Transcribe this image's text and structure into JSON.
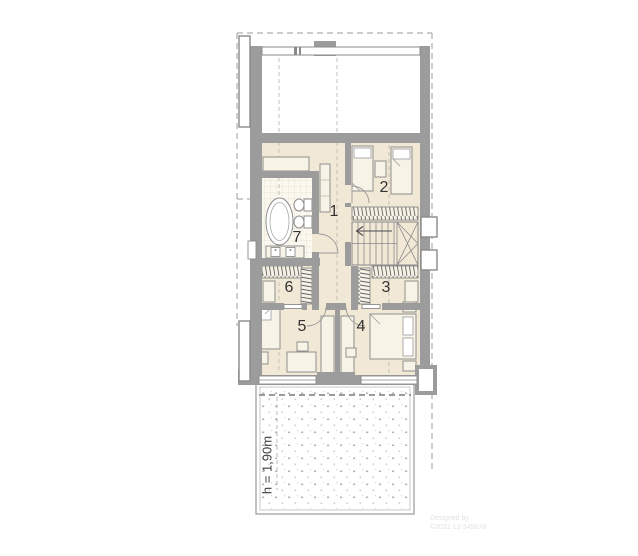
{
  "title": "upper floor plan",
  "labels": {
    "room1": "1",
    "room2": "2",
    "room3": "3",
    "room4": "4",
    "room5": "5",
    "room6": "6",
    "room7": "7"
  },
  "annotations": {
    "height_note": "h = 1,90m"
  },
  "watermark": {
    "line1": "Designed by",
    "line2": "©2021 12-345678"
  },
  "colors": {
    "wall": "#9c9c9c",
    "wall_line": "#8a8a8a",
    "floor": "#f2e8d6",
    "tile_floor": "#fbf8ef",
    "furniture": "#f8f3e7",
    "hatch": "#636363",
    "roof_dash": "#aeaeae",
    "axis_dash": "#c6c1b5",
    "terrace_dot": "#b4b4b4",
    "label_text": "#333333",
    "note_text": "#3f3f3f",
    "watermark_text": "#e2e2e2"
  }
}
